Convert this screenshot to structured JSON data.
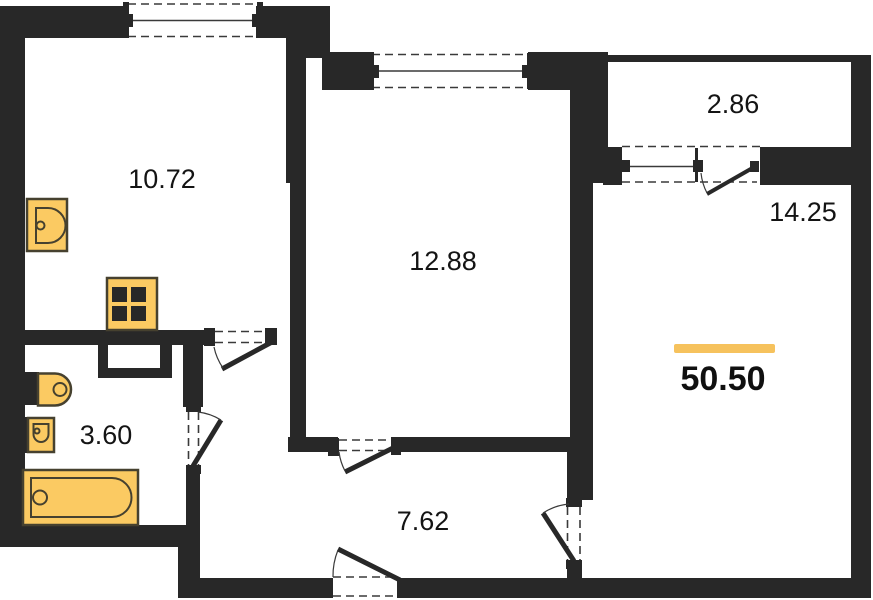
{
  "plan": {
    "rooms": {
      "kitchen": {
        "name": "kitchen",
        "area": "10.72"
      },
      "living_room": {
        "name": "living-room",
        "area": "12.88"
      },
      "balcony": {
        "name": "balcony",
        "area": "2.86"
      },
      "bedroom": {
        "name": "bedroom",
        "area": "14.25"
      },
      "bathroom": {
        "name": "bathroom",
        "area": "3.60"
      },
      "hallway": {
        "name": "hallway",
        "area": "7.62"
      }
    },
    "total_area": "50.50",
    "fixtures": [
      "kitchen-sink",
      "stove",
      "toilet",
      "washbasin",
      "bathtub"
    ],
    "openings": {
      "windows": 3,
      "doors": 6
    },
    "colors": {
      "wall": "#282828",
      "line": "#3a3a3a",
      "fixture_fill": "#fbca62",
      "fixture_stroke": "#46412f",
      "accent": "#f6c25d",
      "background": "#ffffff"
    }
  }
}
